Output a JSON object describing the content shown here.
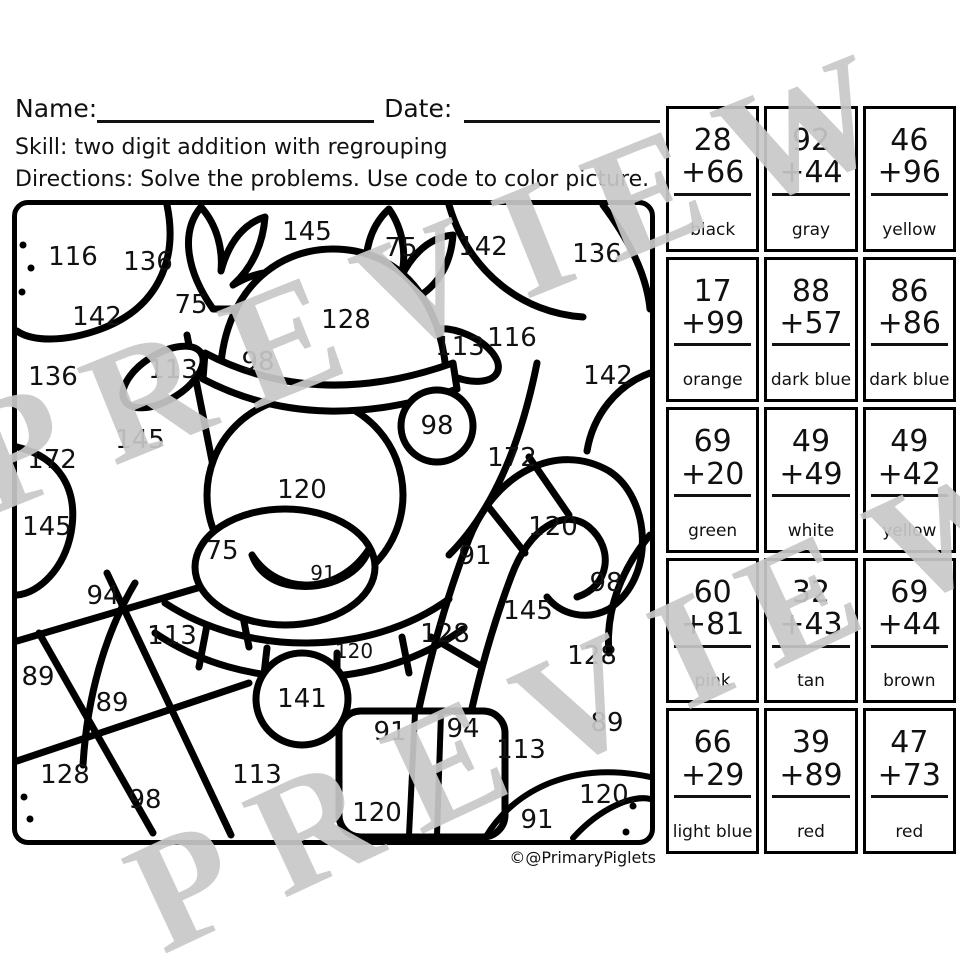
{
  "header": {
    "name_label": "Name:",
    "date_label": "Date:",
    "skill": "Skill: two digit addition with regrouping",
    "directions": "Directions: Solve the problems. Use code to color picture."
  },
  "watermark": {
    "text": "PREVIEW",
    "color": "#c8c8c8"
  },
  "credit": "©@PrimaryPiglets",
  "picture": {
    "numbers": [
      {
        "t": "116",
        "x": 56,
        "y": 52
      },
      {
        "t": "136",
        "x": 131,
        "y": 57
      },
      {
        "t": "145",
        "x": 290,
        "y": 27
      },
      {
        "t": "75",
        "x": 384,
        "y": 43
      },
      {
        "t": "142",
        "x": 466,
        "y": 42
      },
      {
        "t": "136",
        "x": 580,
        "y": 49
      },
      {
        "t": "142",
        "x": 80,
        "y": 112
      },
      {
        "t": "75",
        "x": 174,
        "y": 100
      },
      {
        "t": "128",
        "x": 329,
        "y": 115
      },
      {
        "t": "116",
        "x": 495,
        "y": 133
      },
      {
        "t": "113",
        "x": 443,
        "y": 142
      },
      {
        "t": "136",
        "x": 36,
        "y": 172
      },
      {
        "t": "113",
        "x": 156,
        "y": 165
      },
      {
        "t": "98",
        "x": 241,
        "y": 157
      },
      {
        "t": "142",
        "x": 591,
        "y": 171
      },
      {
        "t": "172",
        "x": 35,
        "y": 255
      },
      {
        "t": "145",
        "x": 123,
        "y": 235
      },
      {
        "t": "98",
        "x": 420,
        "y": 221
      },
      {
        "t": "172",
        "x": 495,
        "y": 253
      },
      {
        "t": "145",
        "x": 30,
        "y": 322
      },
      {
        "t": "120",
        "x": 285,
        "y": 285
      },
      {
        "t": "120",
        "x": 536,
        "y": 322
      },
      {
        "t": "75",
        "x": 205,
        "y": 346
      },
      {
        "t": "91",
        "x": 458,
        "y": 351
      },
      {
        "t": "91",
        "x": 306,
        "y": 368,
        "s": "small"
      },
      {
        "t": "94",
        "x": 86,
        "y": 391
      },
      {
        "t": "98",
        "x": 589,
        "y": 378
      },
      {
        "t": "113",
        "x": 155,
        "y": 431
      },
      {
        "t": "145",
        "x": 511,
        "y": 406
      },
      {
        "t": "128",
        "x": 428,
        "y": 429
      },
      {
        "t": "128",
        "x": 575,
        "y": 451
      },
      {
        "t": "120",
        "x": 337,
        "y": 446,
        "s": "small"
      },
      {
        "t": "89",
        "x": 21,
        "y": 472
      },
      {
        "t": "89",
        "x": 95,
        "y": 498
      },
      {
        "t": "141",
        "x": 285,
        "y": 494
      },
      {
        "t": "94",
        "x": 446,
        "y": 524
      },
      {
        "t": "91",
        "x": 373,
        "y": 527
      },
      {
        "t": "113",
        "x": 504,
        "y": 545
      },
      {
        "t": "89",
        "x": 590,
        "y": 518
      },
      {
        "t": "128",
        "x": 48,
        "y": 570
      },
      {
        "t": "98",
        "x": 128,
        "y": 595
      },
      {
        "t": "113",
        "x": 240,
        "y": 570
      },
      {
        "t": "120",
        "x": 360,
        "y": 608
      },
      {
        "t": "91",
        "x": 520,
        "y": 615
      },
      {
        "t": "120.",
        "x": 591,
        "y": 590
      }
    ]
  },
  "key": {
    "cells": [
      {
        "top": "28",
        "bottom": "+66",
        "color": "black"
      },
      {
        "top": "92",
        "bottom": "+44",
        "color": "gray"
      },
      {
        "top": "46",
        "bottom": "+96",
        "color": "yellow"
      },
      {
        "top": "17",
        "bottom": "+99",
        "color": "orange"
      },
      {
        "top": "88",
        "bottom": "+57",
        "color": "dark blue"
      },
      {
        "top": "86",
        "bottom": "+86",
        "color": "dark blue"
      },
      {
        "top": "69",
        "bottom": "+20",
        "color": "green"
      },
      {
        "top": "49",
        "bottom": "+49",
        "color": "white"
      },
      {
        "top": "49",
        "bottom": "+42",
        "color": "yellow"
      },
      {
        "top": "60",
        "bottom": "+81",
        "color": "pink"
      },
      {
        "top": "32",
        "bottom": "+43",
        "color": "tan"
      },
      {
        "top": "69",
        "bottom": "+44",
        "color": "brown"
      },
      {
        "top": "66",
        "bottom": "+29",
        "color": "light blue"
      },
      {
        "top": "39",
        "bottom": "+89",
        "color": "red"
      },
      {
        "top": "47",
        "bottom": "+73",
        "color": "red"
      }
    ]
  }
}
